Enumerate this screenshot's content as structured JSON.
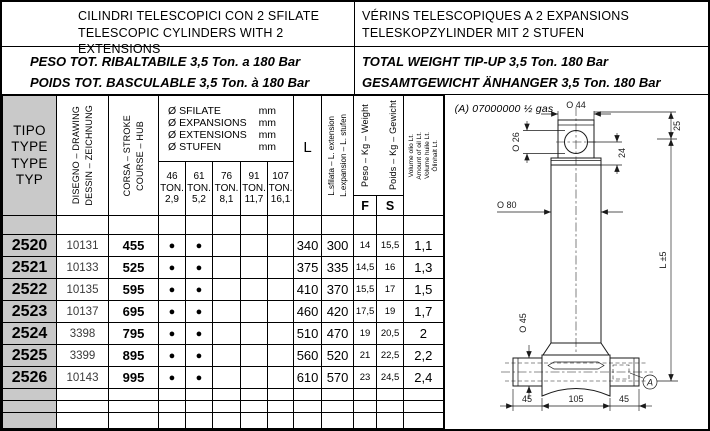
{
  "header": {
    "titles_left": [
      "CILINDRI TELESCOPICI CON 2 SFILATE",
      "TELESCOPIC CYLINDERS WITH 2 EXTENSIONS"
    ],
    "titles_right": [
      "VÉRINS TELESCOPIQUES A 2 EXPANSIONS",
      "TELESKOPZYLINDER MIT 2 STUFEN"
    ],
    "weight_left": [
      "PESO TOT. RIBALTABILE 3,5 Ton. a 180 Bar",
      "POIDS TOT. BASCULABLE 3,5 Ton. à 180 Bar"
    ],
    "weight_right": [
      "TOTAL WEIGHT TIP-UP 3,5 Ton. 180 Bar",
      "GESAMTGEWICHT ÄNHANGER 3,5 Ton. 180 Bar"
    ]
  },
  "table": {
    "type_header": [
      "TIPO",
      "TYPE",
      "TYPE",
      "TYP"
    ],
    "drawing_header": [
      "DISEGNO – DRAWING",
      "DESSIN – ZEICHNUNG"
    ],
    "stroke_header": [
      "CORSA – STROKE",
      "COURSE – HUB"
    ],
    "diameters_header": [
      {
        "label": "Ø SFILATE",
        "unit": "mm"
      },
      {
        "label": "Ø EXPANSIONS",
        "unit": "mm"
      },
      {
        "label": "Ø EXTENSIONS",
        "unit": "mm"
      },
      {
        "label": "Ø STUFEN",
        "unit": "mm"
      }
    ],
    "ton_columns": [
      [
        "46",
        "TON.",
        "2,9"
      ],
      [
        "61",
        "TON.",
        "5,2"
      ],
      [
        "76",
        "TON.",
        "8,1"
      ],
      [
        "91",
        "TON.",
        "11,7"
      ],
      [
        "107",
        "TON.",
        "16,1"
      ]
    ],
    "length_header": "L",
    "extension_header": [
      "L.sfilata – L. extension",
      "L.expansion – L. stufen"
    ],
    "weight_header": [
      "Peso – Kg – Weight",
      "Poids – Kg – Gewicht"
    ],
    "weight_sub": [
      "F",
      "S"
    ],
    "volume_header": [
      "Volume olio Lt.",
      "Amount of oil Lt.",
      "Volume huile Lt.",
      "Ölinhalt Lt."
    ],
    "rows": [
      {
        "type": "2520",
        "drawing": "10131",
        "stroke": "455",
        "dots": [
          "●",
          "●",
          "",
          "",
          ""
        ],
        "L": "340",
        "extension": "300",
        "F": "14",
        "S": "15,5",
        "volume": "1,1"
      },
      {
        "type": "2521",
        "drawing": "10133",
        "stroke": "525",
        "dots": [
          "●",
          "●",
          "",
          "",
          ""
        ],
        "L": "375",
        "extension": "335",
        "F": "14,5",
        "S": "16",
        "volume": "1,3"
      },
      {
        "type": "2522",
        "drawing": "10135",
        "stroke": "595",
        "dots": [
          "●",
          "●",
          "",
          "",
          ""
        ],
        "L": "410",
        "extension": "370",
        "F": "15,5",
        "S": "17",
        "volume": "1,5"
      },
      {
        "type": "2523",
        "drawing": "10137",
        "stroke": "695",
        "dots": [
          "●",
          "●",
          "",
          "",
          ""
        ],
        "L": "460",
        "extension": "420",
        "F": "17,5",
        "S": "19",
        "volume": "1,7"
      },
      {
        "type": "2524",
        "drawing": "3398",
        "stroke": "795",
        "dots": [
          "●",
          "●",
          "",
          "",
          ""
        ],
        "L": "510",
        "extension": "470",
        "F": "19",
        "S": "20,5",
        "volume": "2"
      },
      {
        "type": "2525",
        "drawing": "3399",
        "stroke": "895",
        "dots": [
          "●",
          "●",
          "",
          "",
          ""
        ],
        "L": "560",
        "extension": "520",
        "F": "21",
        "S": "22,5",
        "volume": "2,2"
      },
      {
        "type": "2526",
        "drawing": "10143",
        "stroke": "995",
        "dots": [
          "●",
          "●",
          "",
          "",
          ""
        ],
        "L": "610",
        "extension": "570",
        "F": "23",
        "S": "24,5",
        "volume": "2,4"
      }
    ]
  },
  "drawing": {
    "note": "(A) 07000000 ½ gas",
    "labels": {
      "top_diameter": "O 44",
      "eye_hole_diameter": "O 26",
      "eye_offset": "24",
      "head_length": "25",
      "body_diameter": "O 80",
      "closed_length": "L ±5",
      "pin_diameter": "O 45",
      "base_left": "45",
      "base_center": "105",
      "base_right": "45",
      "port_marker": "A"
    }
  },
  "colors": {
    "header_gray": "#c9c9c9"
  }
}
